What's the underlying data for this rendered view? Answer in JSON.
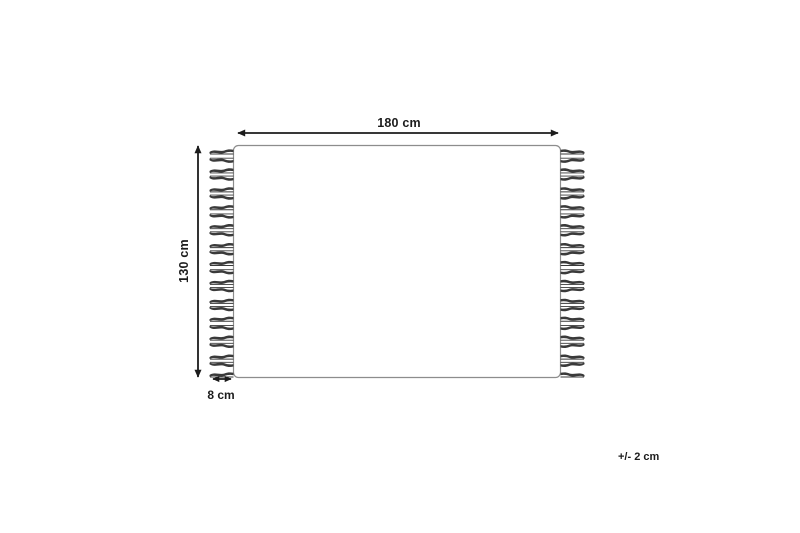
{
  "diagram": {
    "kind": "rug-dimension-diagram",
    "labels": {
      "width": "180 cm",
      "height": "130 cm",
      "fringe_length": "8 cm",
      "tolerance": "+/- 2 cm"
    },
    "colors": {
      "background": "#ffffff",
      "rug_outline": "#8d8d8d",
      "arrow": "#1c1c1c",
      "tassel": "#3a3a3a",
      "text": "#1c1c1c"
    },
    "layout": {
      "rug": {
        "x": 233.5,
        "y": 145.5,
        "width": 327,
        "height": 232,
        "corner_radius": 5
      },
      "fringe": {
        "count_per_side": 25,
        "length": 24,
        "top_y": 151.5,
        "bottom_y": 374.5
      }
    }
  }
}
